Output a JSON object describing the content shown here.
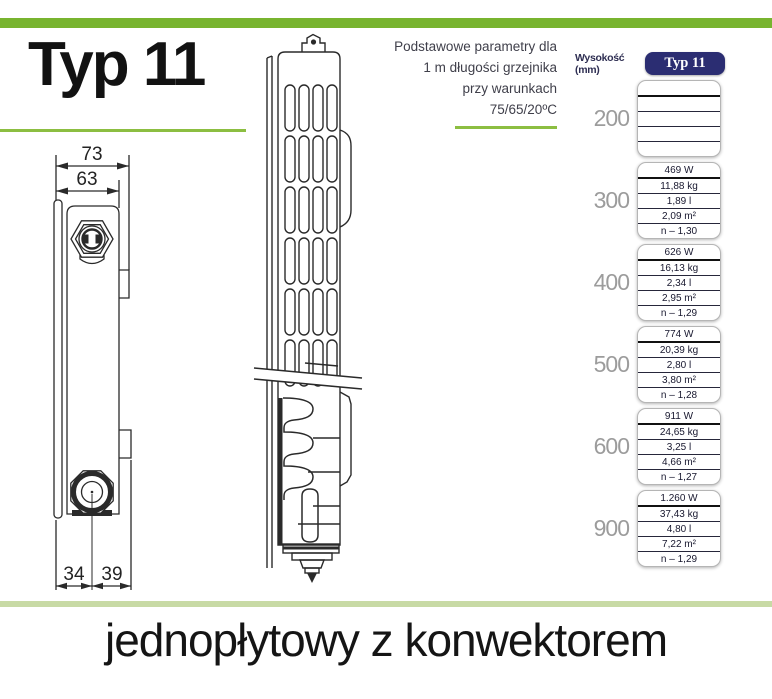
{
  "title": "Typ 11",
  "bottom_caption": "jednopłytowy z konwektorem",
  "params_note": {
    "line1": "Podstawowe parametry dla",
    "line2": "1 m długości grzejnika",
    "line3": "przy warunkach",
    "line4": "75/65/20ºC"
  },
  "drawing": {
    "dim_outer_width": "73",
    "dim_inner_width": "63",
    "dim_bottom_left": "34",
    "dim_bottom_right": "39"
  },
  "table": {
    "height_header": "Wysokość (mm)",
    "type_header": "Typ 11",
    "rows": [
      {
        "height": "200",
        "values": [
          "",
          "",
          "",
          "",
          ""
        ]
      },
      {
        "height": "300",
        "values": [
          "469 W",
          "11,88 kg",
          "1,89 l",
          "2,09 m²",
          "n – 1,30"
        ]
      },
      {
        "height": "400",
        "values": [
          "626 W",
          "16,13 kg",
          "2,34 l",
          "2,95 m²",
          "n – 1,29"
        ]
      },
      {
        "height": "500",
        "values": [
          "774 W",
          "20,39 kg",
          "2,80 l",
          "3,80 m²",
          "n – 1,28"
        ]
      },
      {
        "height": "600",
        "values": [
          "911 W",
          "24,65 kg",
          "3,25 l",
          "4,66 m²",
          "n – 1,27"
        ]
      },
      {
        "height": "900",
        "values": [
          "1.260 W",
          "37,43 kg",
          "4,80 l",
          "7,22 m²",
          "n – 1,29"
        ]
      }
    ]
  },
  "colors": {
    "accent_green": "#78b42f",
    "line_green": "#8cbe41",
    "pale_green": "#c8daa5",
    "badge_navy": "#2b2d72"
  }
}
